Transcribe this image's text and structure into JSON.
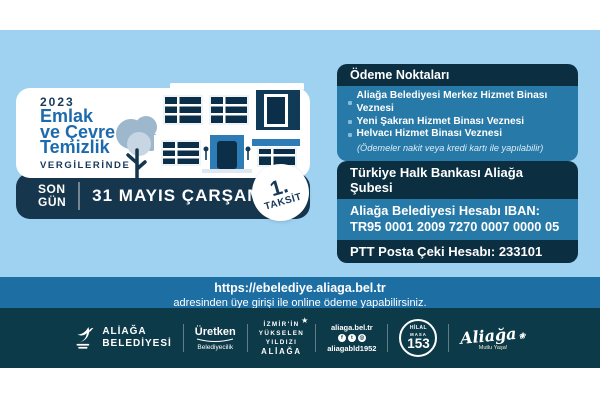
{
  "colors": {
    "background": "#9ed2f0",
    "navy": "#16364d",
    "panel_header": "#0b2e41",
    "panel_body": "#2779a7",
    "link_bar": "#1d6fa3",
    "footer": "#0d3a49",
    "title_blue": "#1d6bad"
  },
  "promo": {
    "year": "2023",
    "title_lines": [
      "Emlak",
      "ve Çevre",
      "Temizlik"
    ],
    "subtitle": "VERGİLERİNDE",
    "deadline_label_lines": [
      "SON",
      "GÜN"
    ],
    "deadline_date": "31 MAYIS ÇARŞAMBA",
    "installment_number": "1.",
    "installment_label": "TAKSİT"
  },
  "payment_points": {
    "header": "Ödeme Noktaları",
    "items": [
      "Aliağa Belediyesi Merkez Hizmet Binası Veznesi",
      "Yeni Şakran Hizmet Binası Veznesi",
      "Helvacı Hizmet Binası Veznesi"
    ],
    "note": "(Ödemeler nakit veya kredi kartı ile yapılabilir)"
  },
  "bank_info": {
    "bank": "Türkiye Halk Bankası Aliağa Şubesi",
    "iban_label": "Aliağa Belediyesi Hesabı IBAN:",
    "iban": "TR95 0001 2009 7270 0007 0000 05",
    "ptt": "PTT Posta Çeki Hesabı: 233101"
  },
  "online_payment": {
    "url": "https://ebelediye.aliaga.bel.tr",
    "note": "adresinden üye girişi ile online ödeme yapabilirsiniz."
  },
  "footer": {
    "municipality_line1": "ALİAĞA",
    "municipality_line2": "BELEDİYESİ",
    "uretken_main": "Üretken",
    "uretken_sub": "Belediyecilik",
    "yildiz_lines": [
      "İZMİR'İN",
      "YÜKSELEN",
      "YILDIZI",
      "ALİAĞA"
    ],
    "website": "aliaga.bel.tr",
    "social_handle": "aliagabld1952",
    "hilal_line1": "HİLAL",
    "hilal_line2": "MASA",
    "hilal_number": "153",
    "script_brand": "Aliağa",
    "script_sub": "Mutlu Yaşa!"
  },
  "icons": {
    "star": "★",
    "flower": "❀",
    "facebook": "f",
    "twitter": "t",
    "instagram": "◎"
  }
}
